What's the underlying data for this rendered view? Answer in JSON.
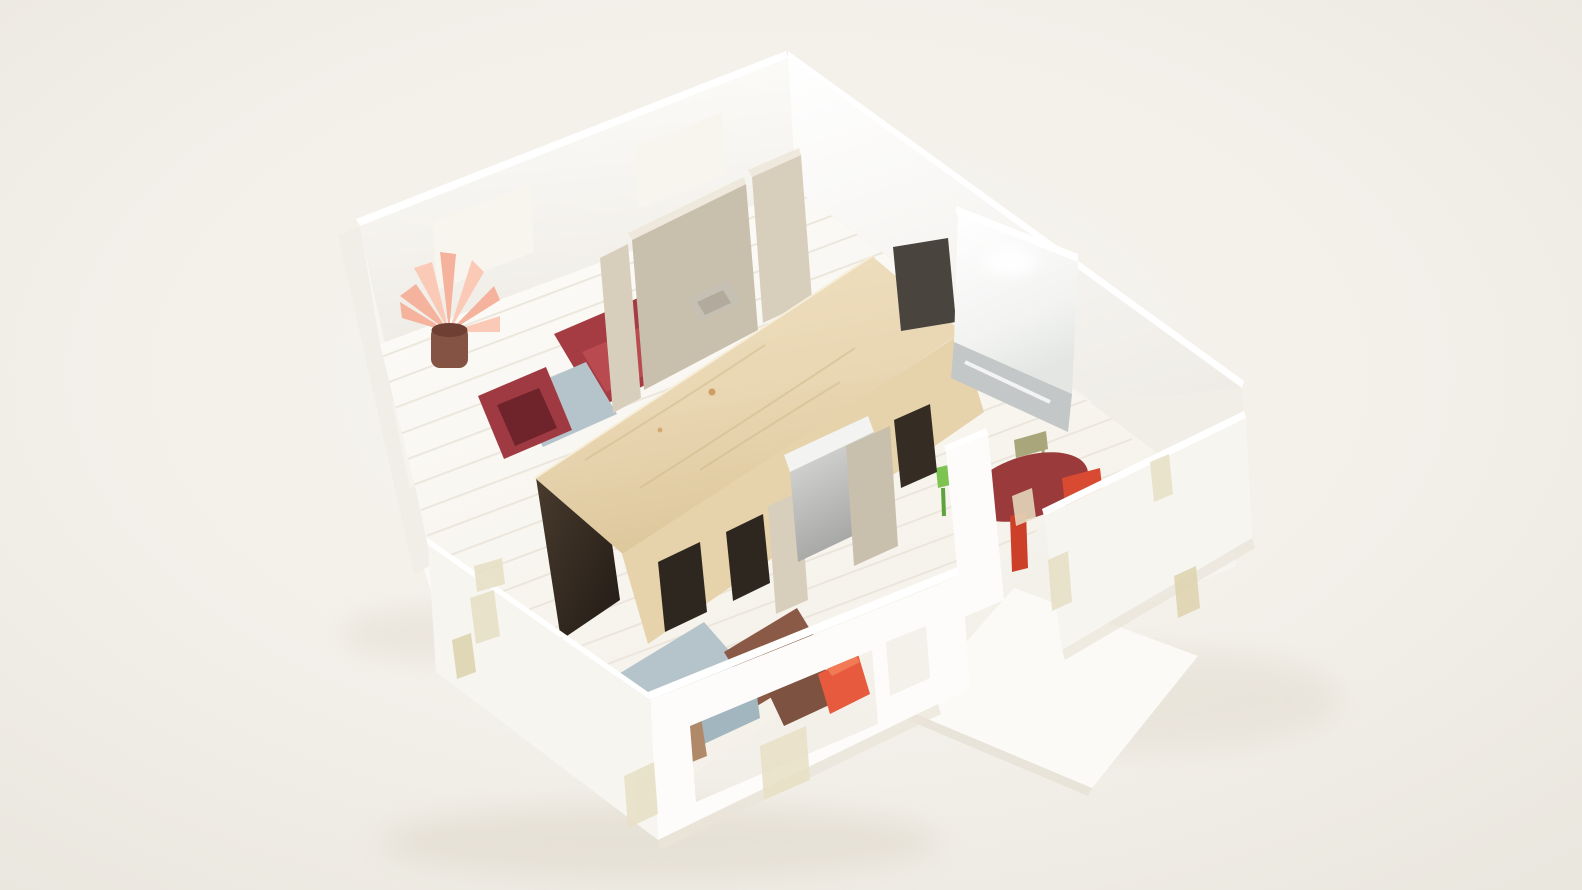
{
  "scene": {
    "title": "Architectural scale model photograph",
    "description": "Bird's-eye photograph of a white paper architectural model of an apartment with a plywood core volume, cardboard bathroom partitions and miniature colored paper furniture, on a warm white table.",
    "objects": [
      "white outer walls with window openings",
      "plywood-roofed core box with dark door openings",
      "cardboard bathroom partition walls and shower tray",
      "glossy white service core and mirror strip",
      "dark red sofa, dark red armchair, blue-gray coffee table",
      "pink paper plant in brown pot",
      "dining room with dark red oval table, green, olive and red chairs",
      "bedroom with blue-gray rug, brown rugs, orange bed, blue couch, small wooden figure",
      "entrance porch slab and terrace slab",
      "masking tape patches on walls"
    ]
  },
  "palette": {
    "bg": "#f3f0e9",
    "shadow_soft": "#ddd6c7",
    "base_white": "#fbfaf6",
    "base_edge": "#e9e4d9",
    "wall_bright": "#fdfcfa",
    "wall_face": "#f7f5f0",
    "wall_shaded": "#f1eee8",
    "wall_top": "#ffffff",
    "window_light": "#f8f5ee",
    "floor": "#fbf9f4",
    "floor_line": "#e9e3d8",
    "interior_white": "#f7f5f0",
    "tape": "#e7dfc4",
    "tape_dark": "#ddd2ae",
    "cardboard": "#c9bfad",
    "cardboard_light": "#d8cebc",
    "cardboard_top": "#efe9dd",
    "tray_gray": "#c6c0b4",
    "tray_inner": "#b2ab9d",
    "plywood_front": "#e6d2ab",
    "plywood_grain": "#d2ba8e",
    "wood_knot": "#c98f4e",
    "opening_dark": "#2e2720",
    "slot_dark": "#352d23",
    "silver_top": "#f3f3f1",
    "gray_wedge": "#4a443e",
    "mirror": "#c3c7c7",
    "sofa_red": "#a53b43",
    "sofa_red_light": "#b84a50",
    "armchair_red": "#a03a42",
    "armchair_red_dark": "#6f242c",
    "rug_blue": "#b5c4ca",
    "couch_blue": "#a2b6c0",
    "rug_brown": "#8a5a46",
    "rug_brown_small": "#7e5240",
    "bed_orange": "#e85a3e",
    "bed_orange_light": "#f27a55",
    "table_red": "#9a3a3a",
    "table_leg_red": "#7e2c2c",
    "chair_green": "#7cc352",
    "chair_green_dark": "#5da23c",
    "chair_olive": "#a9a67b",
    "chair_red_bright": "#d84a32",
    "chair_red_under": "#cc3f28",
    "plant_leaf": "#f5b29c",
    "plant_leaf_light": "#fbcab6",
    "pot_brown": "#855344",
    "pot_brown_dark": "#6d4033",
    "figure_wood": "#b08968"
  }
}
